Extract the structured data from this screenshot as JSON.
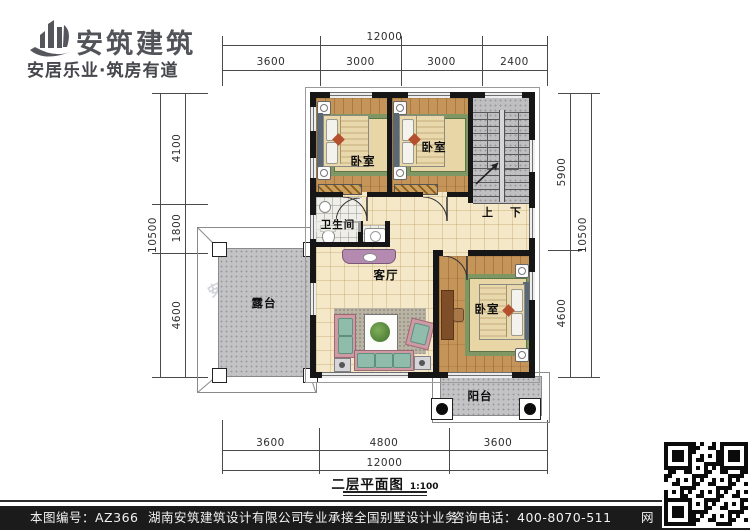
{
  "logo": {
    "name": "安筑建筑",
    "tagline": "安居乐业·筑房有道"
  },
  "rooms": {
    "bedroom": "卧室",
    "bathroom": "卫生间",
    "living": "客厅",
    "terrace": "露台",
    "balcony": "阳台",
    "up": "上",
    "down": "下"
  },
  "dimensions": {
    "top": {
      "total": "12000",
      "segments": [
        "3600",
        "3000",
        "3000",
        "2400"
      ]
    },
    "bottom": {
      "total": "12000",
      "segments": [
        "3600",
        "4800",
        "3600"
      ]
    },
    "left": {
      "total": "10500",
      "segments": [
        "4100",
        "1800",
        "4600"
      ]
    },
    "right": {
      "total": "10500",
      "segments": [
        "5900",
        "4600"
      ]
    }
  },
  "caption": {
    "title": "二层平面图",
    "scale": "1:100"
  },
  "watermarks": {
    "brand": "安筑建筑",
    "site": "hnazjz.com"
  },
  "footer": {
    "drawing_no": "本图编号：AZ366",
    "company": "湖南安筑建筑设计有限公司",
    "service": "专业承接全国别墅设计业务",
    "phone": "咨询电话：400-8070-511",
    "net": "网"
  },
  "colors": {
    "wall": "#161616",
    "wood": "#c59459",
    "tile": "#f5e8c8",
    "concrete": "#c3c3c5",
    "bar": "#1b1b1b"
  }
}
